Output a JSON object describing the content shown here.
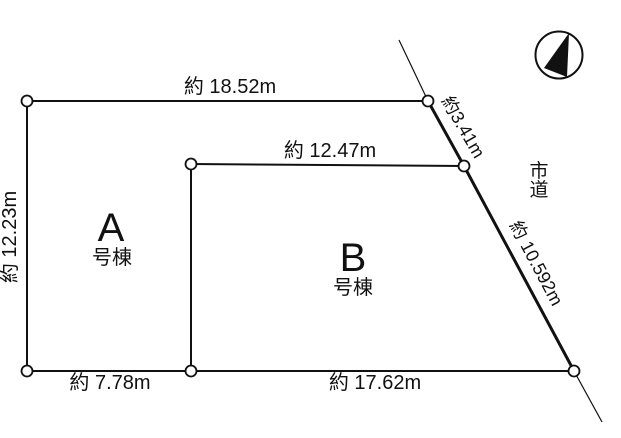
{
  "diagram": {
    "type": "land-plot-survey",
    "background": "#ffffff",
    "line_color": "#111111",
    "vertex_fill": "#ffffff",
    "dimensions": {
      "top_edge": "約 18.52m",
      "upper_right_edge": "約3.41m",
      "inner_top_edge": "約 12.47m",
      "left_edge": "約 12.23m",
      "road_edge": "約 10.592m",
      "bottom_left_edge": "約 7.78m",
      "bottom_right_edge": "約 17.62m"
    },
    "lots": [
      {
        "letter": "A",
        "suffix": "号棟"
      },
      {
        "letter": "B",
        "suffix": "号棟"
      }
    ],
    "road": {
      "name": "市道",
      "chars": [
        "市",
        "道"
      ]
    },
    "compass": {
      "meaning": "north-indicator"
    }
  }
}
